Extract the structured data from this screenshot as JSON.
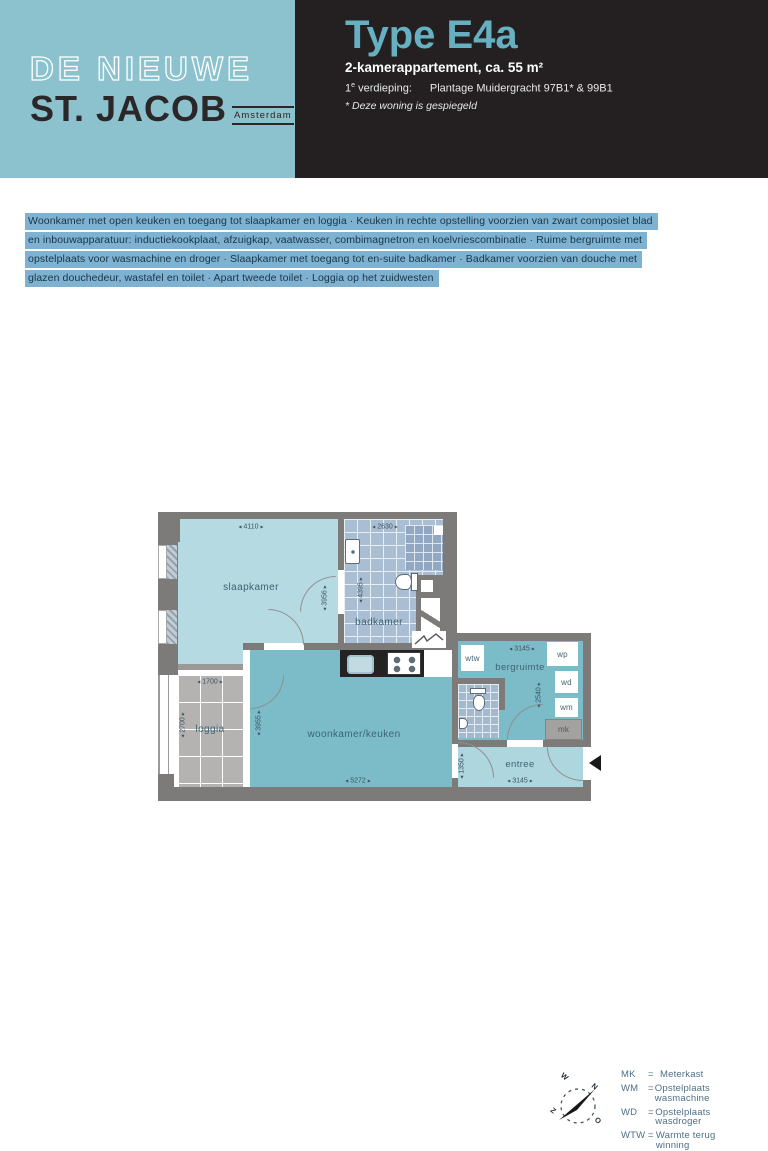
{
  "header": {
    "logo": {
      "line1": "DE NIEUWE",
      "line2": "ST. JACOB",
      "city": "Amsterdam"
    },
    "title": "Type E4a",
    "subtitle": "2-kamerappartement, ca. 55 m²",
    "floor_prefix": "1",
    "floor_sup": "e",
    "floor_word": " verdieping:",
    "address": "Plantage Muidergracht 97B1* & 99B1",
    "note": "* Deze woning is gespiegeld"
  },
  "description": {
    "lines": [
      "Woonkamer met open keuken en toegang tot slaapkamer en loggia · Keuken in rechte opstelling voorzien van zwart composiet blad",
      "en inbouwapparatuur: inductiekookplaat, afzuigkap, vaatwasser, combimagnetron en koelvriescombinatie · Ruime bergruimte met",
      "opstelplaats voor wasmachine en droger · Slaapkamer met toegang tot en-suite badkamer · Badkamer voorzien van douche met",
      "glazen douchedeur, wastafel en toilet · Apart tweede toilet · Loggia op het zuidwesten"
    ]
  },
  "floorplan": {
    "arrows": {
      "left": "◂",
      "right": "▸"
    },
    "rooms": {
      "slaapkamer": {
        "label": "slaapkamer",
        "dim_w": "4110",
        "dim_h": "3956"
      },
      "badkamer": {
        "label": "badkamer",
        "dim_w": "2630",
        "dim_h": "4395"
      },
      "woonkamer": {
        "label": "woonkamer/keuken",
        "dim_w": "5272",
        "dim_h": "3955"
      },
      "loggia": {
        "label": "loggia",
        "dim_w": "1700",
        "dim_h": "2700"
      },
      "bergruimte": {
        "label": "bergruimte",
        "dim_w": "3145",
        "dim_h": "2540"
      },
      "entree": {
        "label": "entree",
        "dim_w": "3145",
        "dim_h": "1350"
      }
    },
    "boxes": {
      "wtw": "wtw",
      "wp": "wp",
      "wd": "wd",
      "wm": "wm",
      "mk": "mk"
    }
  },
  "legend": {
    "separator": "=",
    "items": [
      {
        "abbr": "MK",
        "desc": "Meterkast"
      },
      {
        "abbr": "WM",
        "desc": "Opstelplaats wasmachine"
      },
      {
        "abbr": "WD",
        "desc": "Opstelplaats wasdroger"
      },
      {
        "abbr": "WTW",
        "desc": "Warmte terug winning"
      },
      {
        "abbr": "WP",
        "desc": "Warmtepomp"
      }
    ],
    "compass": {
      "n": "N",
      "o": "O",
      "z": "Z",
      "w": "W"
    }
  }
}
